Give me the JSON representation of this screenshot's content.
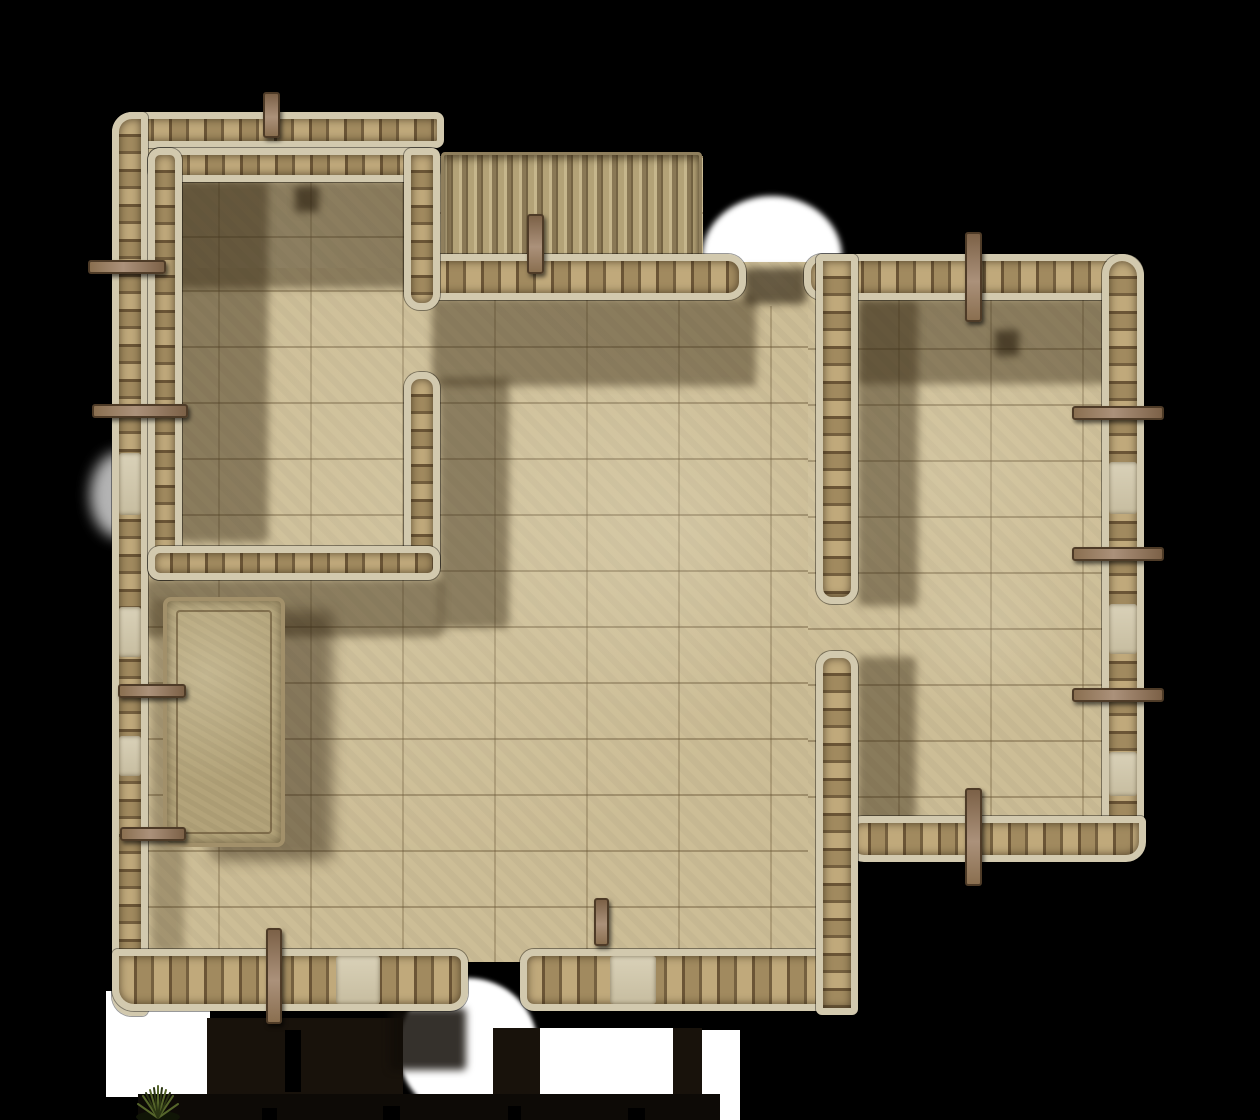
{
  "scene": {
    "type": "tabletop-battlemap",
    "setting": "top-down stone building floor plan on black backdrop",
    "background_color": "#000000"
  },
  "palette": {
    "bg": "#000000",
    "floor": "#cfc099",
    "jamb": "#d2c9ae",
    "stone-light": "#c0a97b",
    "stone-mid": "#a18a5f",
    "stone-dark": "#75603f",
    "mortar": "#6b5536",
    "door": "#d9d1b8",
    "wood": "#9b8064",
    "wood-dark": "#4e3b27",
    "glow": "#ffffff",
    "terrain": "#18120b",
    "terrain-deep": "#0d0a06",
    "stair-light": "#c6b68c",
    "stair-dark": "#8a7855",
    "platform": "#b8a97f",
    "plant-green": "#55652a"
  },
  "features": {
    "rooms": [
      {
        "name": "upper-left-room"
      },
      {
        "name": "main-hall"
      },
      {
        "name": "right-room"
      },
      {
        "name": "lower-right-room"
      }
    ],
    "staircase": {
      "name": "staircase",
      "steps": 17,
      "position": "top-center"
    },
    "platform": {
      "name": "raised-stone-platform",
      "position": "west side of main hall"
    },
    "doorways": [
      {
        "name": "north-entrance-gap",
        "lit": true
      },
      {
        "name": "west-door",
        "lit": true
      },
      {
        "name": "south-entrance-gap",
        "lit": true
      },
      {
        "name": "east-wall-doors",
        "count": 3
      },
      {
        "name": "west-wall-doors",
        "count": 3
      },
      {
        "name": "south-wall-doors",
        "count": 2
      },
      {
        "name": "inner-doorway-upper-left-room"
      },
      {
        "name": "inner-doorway-right-wing"
      }
    ],
    "light_glows": [
      {
        "name": "north-doorway-glow"
      },
      {
        "name": "west-door-glow"
      },
      {
        "name": "south-doorway-glow"
      },
      {
        "name": "south-west-white-patch"
      },
      {
        "name": "south-white-patches",
        "count": 2
      }
    ],
    "props": [
      {
        "name": "support-beam-pegs",
        "count": 13,
        "icon": "wood-beam-icon"
      },
      {
        "name": "grass-tuft",
        "icon": "grass-tuft-icon"
      }
    ]
  }
}
